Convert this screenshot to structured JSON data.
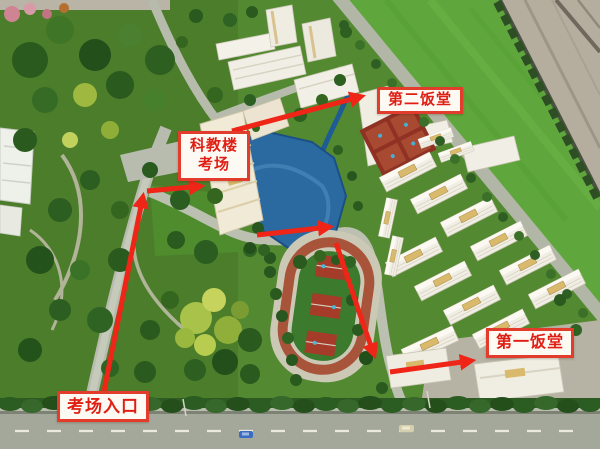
{
  "annotations": {
    "entrance": {
      "label": "考场入口"
    },
    "exam_building": {
      "line1": "科教楼",
      "line2": "考场"
    },
    "second_canteen": {
      "label": "第二饭堂"
    },
    "first_canteen": {
      "label": "第一饭堂"
    }
  },
  "colors": {
    "route_red": "#ee2517",
    "label_text_red": "#e01f14",
    "label_border_red": "#e23c2d",
    "label_background": "#fdfaf4",
    "lawn_green": "#538a31",
    "bright_lawn_green": "#5fa63c",
    "lake_blue": "#2a6aa0",
    "road_gray": "#b2b6a6",
    "track_lane_red": "#a8543a",
    "court_red": "#a53c2a",
    "building_white": "#f1efe5",
    "table_edge_gray": "#b5ae9f"
  }
}
